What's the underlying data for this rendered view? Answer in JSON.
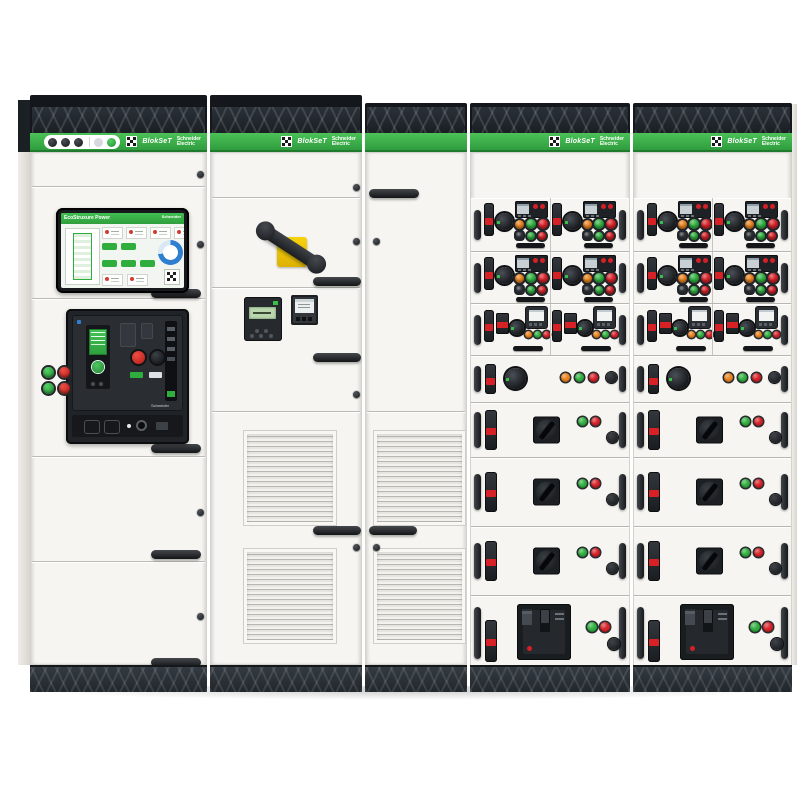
{
  "brand": {
    "product": "BlokSeT",
    "manufacturer": [
      "Schneider",
      "Electric"
    ]
  },
  "hmi": {
    "title": "EcoStruxure Power"
  },
  "palette": {
    "brand_green": "#3cb44a",
    "status_green": "#2fae3e",
    "status_red": "#d42127",
    "status_amber": "#e8821e",
    "safety_yellow": "#f2c500"
  },
  "mcc": {
    "colors": {
      "orange": "#e8821e",
      "green": "#2fae3e",
      "red": "#d42127",
      "dark": "#33373c"
    },
    "rows": [
      {
        "kind": "starter",
        "h": 53,
        "cells": 2,
        "main": [
          "orange",
          "green",
          "red"
        ],
        "aux": [
          "dark",
          "green",
          "red"
        ]
      },
      {
        "kind": "starter",
        "h": 51,
        "cells": 2,
        "main": [
          "orange",
          "green",
          "red"
        ],
        "aux": [
          "dark",
          "green",
          "red"
        ]
      },
      {
        "kind": "metered",
        "h": 51,
        "cells": 2,
        "lights": [
          "orange",
          "green",
          "red"
        ]
      },
      {
        "kind": "compact",
        "h": 46,
        "lights": [
          "orange",
          "green",
          "red"
        ]
      },
      {
        "kind": "switch",
        "h": 54,
        "lights": [
          "green",
          "red"
        ]
      },
      {
        "kind": "switch",
        "h": 68,
        "lights": [
          "green",
          "red"
        ]
      },
      {
        "kind": "switch",
        "h": 68,
        "lights": [
          "green",
          "red"
        ]
      },
      {
        "kind": "breaker",
        "h": 74,
        "lights": [
          "green",
          "red"
        ]
      }
    ]
  }
}
